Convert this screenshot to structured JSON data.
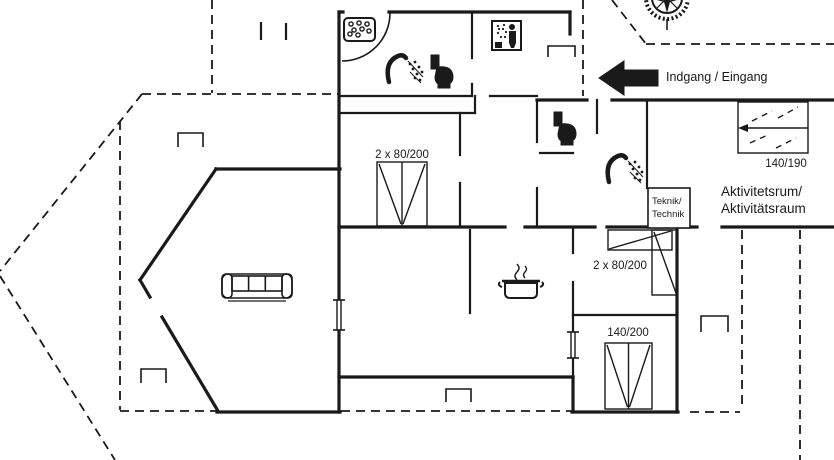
{
  "colors": {
    "ink": "#1a1a1a",
    "paper": "#ffffff"
  },
  "entrance": {
    "label": "Indgang / Eingang",
    "arrow_direction": "left"
  },
  "compass": {
    "name": "compass-rose"
  },
  "rooms": {
    "activity": {
      "line1": "Aktivitetsrum/",
      "line2": "Aktivitätsraum"
    },
    "tech": {
      "line1": "Teknik/",
      "line2": "Technik"
    }
  },
  "beds": {
    "double_top": {
      "label": "2 x 80/200"
    },
    "bunk": {
      "label": "2 x 80/200"
    },
    "sofa_bed": {
      "label": "140/190"
    },
    "double_bottom": {
      "label": "140/200"
    }
  },
  "fixtures": [
    "whirlpool",
    "shower",
    "toilet",
    "shower-cabin",
    "toilet",
    "shower",
    "cooking-pot",
    "sofa"
  ]
}
